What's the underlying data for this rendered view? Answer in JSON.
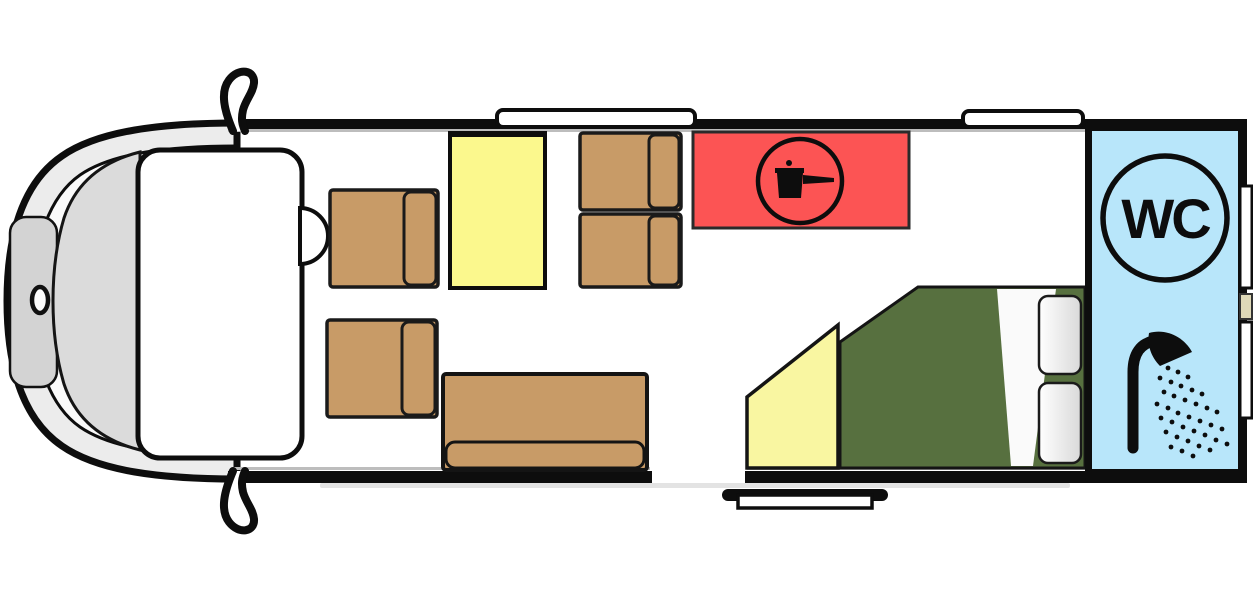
{
  "floorplan": {
    "labels": {
      "wc": "WC"
    },
    "colors": {
      "seat_tan": "#C89B67",
      "table_yellow": "#FBF88D",
      "kitchen_red": "#FC5454",
      "bed_green": "#57703F",
      "bath_blue": "#B8E6FA",
      "wedge_yellow": "#F9F6A1",
      "pillow_light": "#F2F2F2",
      "body_gray": "#ECECEC",
      "hood_gray": "#D3D3D3",
      "windshield_gray": "#DBDBDB",
      "rear_hatch_beige": "#DFD9B8",
      "outline_black": "#0D0D0D"
    },
    "icons": [
      {
        "name": "pot-on-hob-icon",
        "meaning": "kitchen / cooker"
      },
      {
        "name": "wc-roundel-icon",
        "meaning": "toilet"
      },
      {
        "name": "shower-spray-icon",
        "meaning": "shower"
      }
    ],
    "areas": [
      {
        "name": "driver-cab",
        "color_key": "body_gray"
      },
      {
        "name": "swivel-seat-top",
        "color_key": "seat_tan"
      },
      {
        "name": "swivel-seat-bottom",
        "color_key": "seat_tan"
      },
      {
        "name": "dinette-table",
        "color_key": "table_yellow"
      },
      {
        "name": "dinette-seat-upper",
        "color_key": "seat_tan"
      },
      {
        "name": "dinette-seat-lower",
        "color_key": "seat_tan"
      },
      {
        "name": "sofa-bench",
        "color_key": "seat_tan"
      },
      {
        "name": "kitchen-block",
        "color_key": "kitchen_red"
      },
      {
        "name": "wardrobe-wedge",
        "color_key": "wedge_yellow"
      },
      {
        "name": "rear-bed",
        "color_key": "bed_green"
      },
      {
        "name": "bathroom",
        "color_key": "bath_blue"
      }
    ]
  }
}
